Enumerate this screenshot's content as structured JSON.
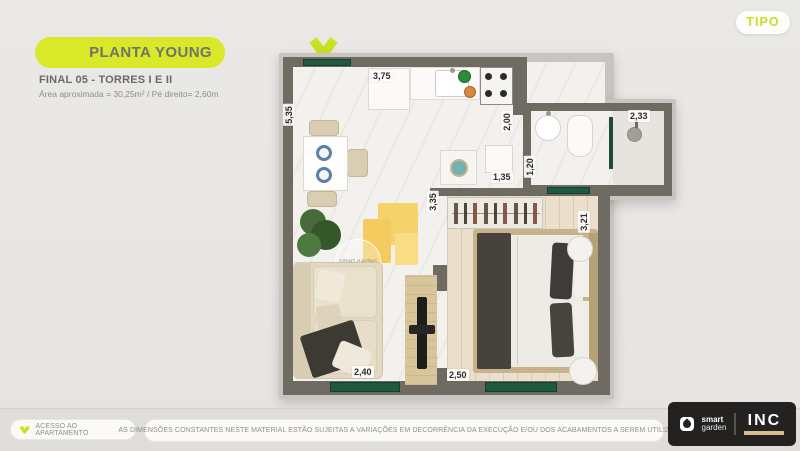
{
  "header": {
    "title": "PLANTA YOUNG",
    "subtitle": "FINAL 05 - TORRES I E II",
    "area_info": "Área aproximada = 30,25m² / Pé direito= 2,60m"
  },
  "tipo": {
    "label": "TIPO"
  },
  "plan": {
    "watermark": "smart garden",
    "dims": {
      "kitchen_top": "3,75",
      "left_side": "5,35",
      "kitchen_depth": "2,00",
      "bath_width": "2,33",
      "bath_depth": "1,20",
      "cabinet": "1,35",
      "hall": "3,35",
      "bedroom_side": "3,21",
      "living_bottom": "2,40",
      "bedroom_bottom": "2,50"
    }
  },
  "footer": {
    "access_label": "ACESSO AO APARTAMENTO",
    "disclaimer": "AS DIMENSÕES CONSTANTES NESTE MATERIAL ESTÃO SUJEITAS A VARIAÇÕES EM DECORRÊNCIA DA EXECUÇÃO E/OU DOS ACABAMENTOS A SEREM UTILIZADOS",
    "logo": {
      "smart_top": "smart",
      "smart_bottom": "garden",
      "inc": "INC"
    }
  },
  "icons": {
    "entry_chevron": "chevron-down",
    "access_chevron": "chevron-down",
    "smart_garden_leaf": "leaf"
  },
  "colors": {
    "accent_lime": "#d9e829",
    "window_green": "#1d5a40",
    "wall_gray": "#6f6b63",
    "logo_bg": "#232220",
    "page_bg": "#eae8e5"
  }
}
